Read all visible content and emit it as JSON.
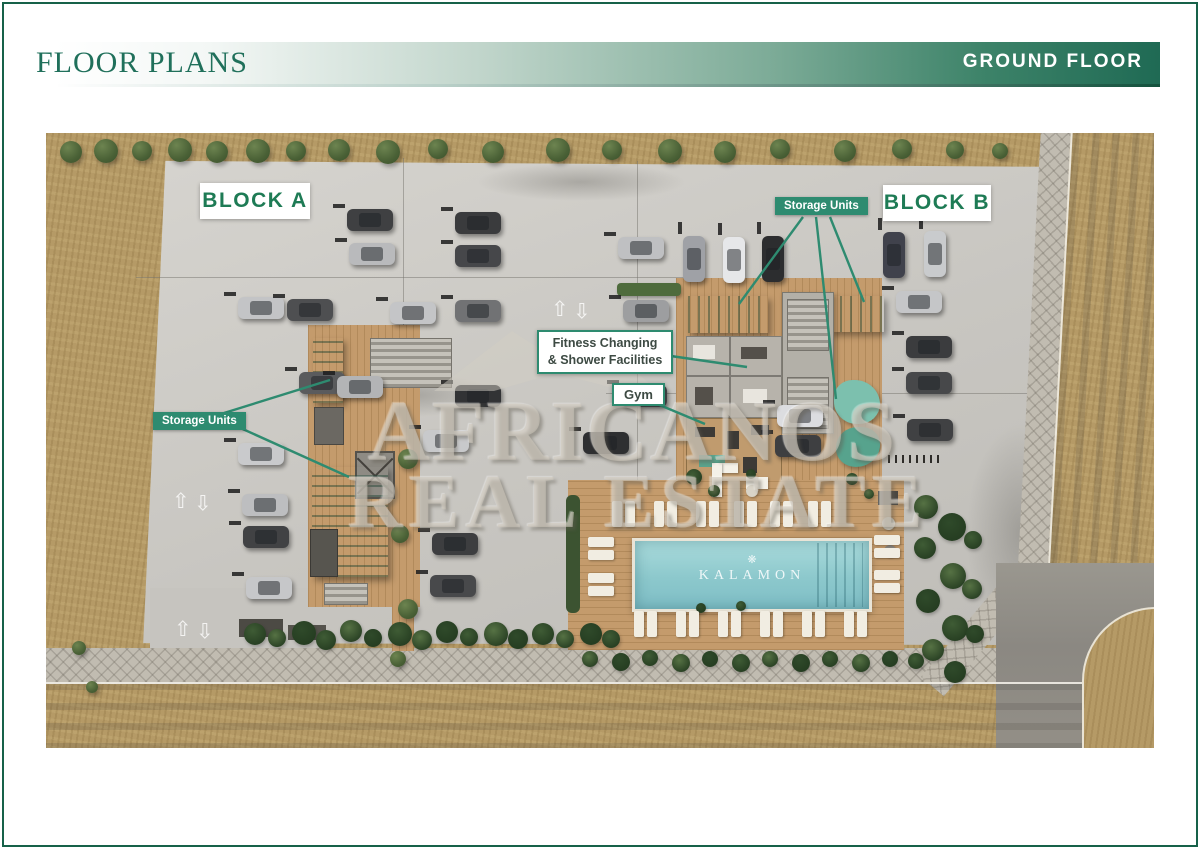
{
  "header": {
    "title": "FLOOR PLANS",
    "floor_badge": "GROUND FLOOR"
  },
  "plan": {
    "labels": {
      "block_a": "BLOCK A",
      "block_b": "BLOCK B",
      "storage_units_left": "Storage Units",
      "storage_units_right": "Storage Units",
      "fitness_line1": "Fitness Changing",
      "fitness_line2": "& Shower Facilities",
      "gym": "Gym"
    },
    "pool": {
      "name": "KALAMON",
      "emblem": "❋"
    },
    "watermark": {
      "line1": "AFRICANOS",
      "line2": "REAL ESTATE"
    },
    "colors": {
      "brand_green": "#2e8b70",
      "header_green": "#20705b",
      "band_dark_end": "#1f6a54",
      "block_label_text": "#1e7b55",
      "canopy_green": "#3e8a6d",
      "pool_water": "#8cc8cc",
      "wood_deck": "#c49b6c",
      "concrete": "#c8c6c1",
      "asphalt": "#8b8882",
      "grass": "#b59a66"
    },
    "cars": [
      {
        "x": 301,
        "y": 76,
        "o": "h",
        "c": "#3f4042"
      },
      {
        "x": 303,
        "y": 110,
        "o": "h",
        "c": "#b9babc"
      },
      {
        "x": 192,
        "y": 164,
        "o": "h",
        "c": "#c3c4c6"
      },
      {
        "x": 241,
        "y": 166,
        "o": "h",
        "c": "#4e4f51"
      },
      {
        "x": 192,
        "y": 310,
        "o": "h",
        "c": "#c9cacc"
      },
      {
        "x": 196,
        "y": 361,
        "o": "h",
        "c": "#bdbec0"
      },
      {
        "x": 197,
        "y": 393,
        "o": "h",
        "c": "#414244"
      },
      {
        "x": 200,
        "y": 444,
        "o": "h",
        "c": "#c6c7c9"
      },
      {
        "x": 253,
        "y": 239,
        "o": "h",
        "c": "#5a5b5d"
      },
      {
        "x": 291,
        "y": 243,
        "o": "h",
        "c": "#b3b4b6"
      },
      {
        "x": 409,
        "y": 79,
        "o": "h",
        "c": "#3a3b3d"
      },
      {
        "x": 409,
        "y": 112,
        "o": "h",
        "c": "#46474a"
      },
      {
        "x": 344,
        "y": 169,
        "o": "h",
        "c": "#c4c5c7"
      },
      {
        "x": 409,
        "y": 167,
        "o": "h",
        "c": "#717274"
      },
      {
        "x": 409,
        "y": 252,
        "o": "h",
        "c": "#323335"
      },
      {
        "x": 377,
        "y": 297,
        "o": "h",
        "c": "#c8c9cb"
      },
      {
        "x": 386,
        "y": 400,
        "o": "h",
        "c": "#3d3e40"
      },
      {
        "x": 384,
        "y": 442,
        "o": "h",
        "c": "#48494b"
      },
      {
        "x": 572,
        "y": 104,
        "o": "h",
        "c": "#bfc0c2"
      },
      {
        "x": 577,
        "y": 167,
        "o": "h",
        "c": "#9d9ea0"
      },
      {
        "x": 575,
        "y": 252,
        "o": "h",
        "c": "#424346"
      },
      {
        "x": 537,
        "y": 299,
        "o": "h",
        "c": "#2e2f31"
      },
      {
        "x": 637,
        "y": 103,
        "o": "v",
        "c": "#9fa1a6"
      },
      {
        "x": 677,
        "y": 104,
        "o": "v",
        "c": "#e6e7e9"
      },
      {
        "x": 716,
        "y": 103,
        "o": "v",
        "c": "#2c2d2f"
      },
      {
        "x": 837,
        "y": 99,
        "o": "v",
        "c": "#40424c"
      },
      {
        "x": 878,
        "y": 98,
        "o": "v",
        "c": "#c9cbcd"
      },
      {
        "x": 850,
        "y": 158,
        "o": "h",
        "c": "#c5c6c8"
      },
      {
        "x": 860,
        "y": 203,
        "o": "h",
        "c": "#3b3c3e"
      },
      {
        "x": 860,
        "y": 239,
        "o": "h",
        "c": "#47484a"
      },
      {
        "x": 861,
        "y": 286,
        "o": "h",
        "c": "#404143"
      },
      {
        "x": 731,
        "y": 272,
        "o": "h",
        "c": "#dcdde0"
      },
      {
        "x": 729,
        "y": 302,
        "o": "h",
        "c": "#3e3f41"
      }
    ],
    "trees": [
      {
        "x": 14,
        "y": 8,
        "r": 11
      },
      {
        "x": 48,
        "y": 6,
        "r": 12
      },
      {
        "x": 86,
        "y": 8,
        "r": 10
      },
      {
        "x": 122,
        "y": 5,
        "r": 12
      },
      {
        "x": 160,
        "y": 8,
        "r": 11
      },
      {
        "x": 200,
        "y": 6,
        "r": 12
      },
      {
        "x": 240,
        "y": 8,
        "r": 10
      },
      {
        "x": 282,
        "y": 6,
        "r": 11
      },
      {
        "x": 330,
        "y": 7,
        "r": 12
      },
      {
        "x": 382,
        "y": 6,
        "r": 10
      },
      {
        "x": 436,
        "y": 8,
        "r": 11
      },
      {
        "x": 500,
        "y": 5,
        "r": 12
      },
      {
        "x": 556,
        "y": 7,
        "r": 10
      },
      {
        "x": 612,
        "y": 6,
        "r": 12
      },
      {
        "x": 668,
        "y": 8,
        "r": 11
      },
      {
        "x": 724,
        "y": 6,
        "r": 10
      },
      {
        "x": 788,
        "y": 7,
        "r": 11
      },
      {
        "x": 846,
        "y": 6,
        "r": 10
      },
      {
        "x": 900,
        "y": 8,
        "r": 9
      },
      {
        "x": 946,
        "y": 10,
        "r": 8
      },
      {
        "x": 352,
        "y": 316,
        "r": 10
      },
      {
        "x": 345,
        "y": 392,
        "r": 9
      },
      {
        "x": 352,
        "y": 466,
        "r": 10
      },
      {
        "x": 344,
        "y": 518,
        "r": 8
      },
      {
        "x": 26,
        "y": 508,
        "r": 7
      },
      {
        "x": 40,
        "y": 548,
        "r": 6
      }
    ],
    "bushes": [
      {
        "x": 198,
        "y": 490,
        "r": 11
      },
      {
        "x": 222,
        "y": 496,
        "r": 9
      },
      {
        "x": 246,
        "y": 488,
        "r": 12
      },
      {
        "x": 270,
        "y": 497,
        "r": 10
      },
      {
        "x": 294,
        "y": 487,
        "r": 11
      },
      {
        "x": 318,
        "y": 496,
        "r": 9
      },
      {
        "x": 342,
        "y": 489,
        "r": 12
      },
      {
        "x": 366,
        "y": 497,
        "r": 10
      },
      {
        "x": 390,
        "y": 488,
        "r": 11
      },
      {
        "x": 414,
        "y": 495,
        "r": 9
      },
      {
        "x": 438,
        "y": 489,
        "r": 12
      },
      {
        "x": 462,
        "y": 496,
        "r": 10
      },
      {
        "x": 486,
        "y": 490,
        "r": 11
      },
      {
        "x": 510,
        "y": 497,
        "r": 9
      },
      {
        "x": 534,
        "y": 490,
        "r": 11
      },
      {
        "x": 556,
        "y": 497,
        "r": 9
      },
      {
        "x": 536,
        "y": 518,
        "r": 8
      },
      {
        "x": 566,
        "y": 520,
        "r": 9
      },
      {
        "x": 596,
        "y": 517,
        "r": 8
      },
      {
        "x": 626,
        "y": 521,
        "r": 9
      },
      {
        "x": 656,
        "y": 518,
        "r": 8
      },
      {
        "x": 686,
        "y": 521,
        "r": 9
      },
      {
        "x": 716,
        "y": 518,
        "r": 8
      },
      {
        "x": 746,
        "y": 521,
        "r": 9
      },
      {
        "x": 776,
        "y": 518,
        "r": 8
      },
      {
        "x": 806,
        "y": 521,
        "r": 9
      },
      {
        "x": 836,
        "y": 518,
        "r": 8
      },
      {
        "x": 862,
        "y": 520,
        "r": 8
      },
      {
        "x": 868,
        "y": 362,
        "r": 12
      },
      {
        "x": 892,
        "y": 380,
        "r": 14
      },
      {
        "x": 868,
        "y": 404,
        "r": 11
      },
      {
        "x": 894,
        "y": 430,
        "r": 13
      },
      {
        "x": 870,
        "y": 456,
        "r": 12
      },
      {
        "x": 896,
        "y": 482,
        "r": 13
      },
      {
        "x": 876,
        "y": 506,
        "r": 11
      },
      {
        "x": 898,
        "y": 528,
        "r": 11
      },
      {
        "x": 918,
        "y": 398,
        "r": 9
      },
      {
        "x": 916,
        "y": 446,
        "r": 10
      },
      {
        "x": 920,
        "y": 492,
        "r": 9
      },
      {
        "x": 640,
        "y": 336,
        "r": 8
      },
      {
        "x": 662,
        "y": 352,
        "r": 6
      },
      {
        "x": 700,
        "y": 336,
        "r": 5
      },
      {
        "x": 800,
        "y": 340,
        "r": 6
      },
      {
        "x": 818,
        "y": 356,
        "r": 5
      },
      {
        "x": 650,
        "y": 470,
        "r": 5
      },
      {
        "x": 690,
        "y": 468,
        "r": 5
      }
    ],
    "loungers": [
      {
        "x": 566,
        "y": 368,
        "o": "v"
      },
      {
        "x": 608,
        "y": 368,
        "o": "v"
      },
      {
        "x": 650,
        "y": 368,
        "o": "v"
      },
      {
        "x": 688,
        "y": 368,
        "o": "v"
      },
      {
        "x": 724,
        "y": 368,
        "o": "v"
      },
      {
        "x": 762,
        "y": 368,
        "o": "v"
      },
      {
        "x": 588,
        "y": 478,
        "o": "v"
      },
      {
        "x": 630,
        "y": 478,
        "o": "v"
      },
      {
        "x": 672,
        "y": 478,
        "o": "v"
      },
      {
        "x": 714,
        "y": 478,
        "o": "v"
      },
      {
        "x": 756,
        "y": 478,
        "o": "v"
      },
      {
        "x": 798,
        "y": 478,
        "o": "v"
      },
      {
        "x": 542,
        "y": 404,
        "o": "h"
      },
      {
        "x": 542,
        "y": 440,
        "o": "h"
      },
      {
        "x": 828,
        "y": 402,
        "o": "h"
      },
      {
        "x": 828,
        "y": 437,
        "o": "h"
      }
    ],
    "pavement_arrows": [
      {
        "x": 505,
        "y": 166
      },
      {
        "x": 126,
        "y": 358
      },
      {
        "x": 128,
        "y": 486
      }
    ]
  }
}
